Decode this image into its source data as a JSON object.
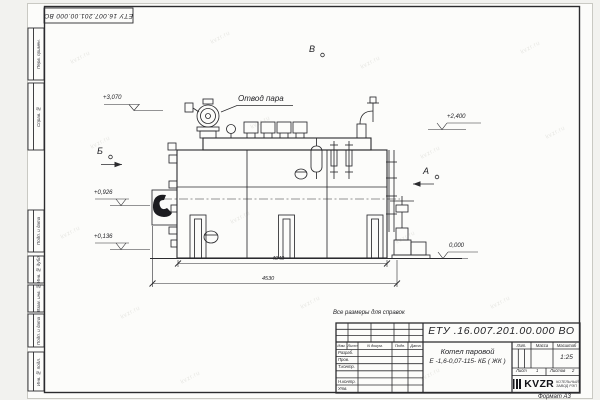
{
  "meta": {
    "watermark": "kvzr.ru",
    "format_label": "Формат А3"
  },
  "frame": {
    "top_stamp": "ЕТУ 16.007.201.00.000  ВО",
    "side_labels": [
      "Перв. примен.",
      "Справ. №",
      "Подп. и дата",
      "Инв. № дубл.",
      "Взам. инв. №",
      "Подп. и дата",
      "Инв. № подл."
    ]
  },
  "drawing": {
    "callout_steam_outlet": "Отвод пара",
    "note": "Все размеры для справок",
    "view_markers": {
      "left": "Б",
      "top": "В",
      "right": "А"
    },
    "elevations": {
      "e3070": "+3,070",
      "e2400": "+2,400",
      "e0926": "+0,926",
      "e0136": "+0,136",
      "e0000": "0,000"
    },
    "dimensions": {
      "inner": "4040",
      "overall": "4530"
    }
  },
  "title_block": {
    "doc_number": "ЕТУ .16.007.201.00.000  ВО",
    "product_line1": "Котел паровой",
    "product_line2": "Е -1,6-0,07-115- КБ ( ЖК )",
    "col_headers": {
      "lit": "Лит.",
      "mass": "Масса",
      "scale": "Масштаб"
    },
    "scale_value": "1:25",
    "sheet_label": "Лист",
    "sheet_value": "1",
    "sheets_label": "Листов",
    "sheets_value": "2",
    "sig_header": {
      "izm": "Изм.",
      "list": "Лист",
      "doc": "N докум.",
      "sign": "Подп.",
      "date": "Дата"
    },
    "sig_rows": {
      "r1": "Разраб.",
      "r2": "Пров.",
      "r3": "Т.контр.",
      "r4": "",
      "r5": "Н.контр.",
      "r6": "Утв."
    },
    "company": {
      "logo": "KVZR",
      "sub1": "КОТЕЛЬНЫЙ",
      "sub2": "ЗАВОД РЭП"
    }
  }
}
